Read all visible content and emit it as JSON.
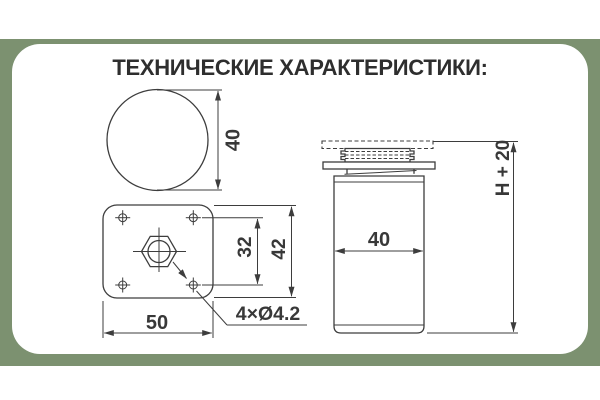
{
  "page": {
    "band_color": "#7c9170",
    "card_color": "#ffffff",
    "line_color": "#3d3d3d",
    "text_color": "#2e2e2e"
  },
  "header": {
    "title": "ТЕХНИЧЕСКИЕ ХАРАКТЕРИСТИКИ:"
  },
  "drawing": {
    "top_view": {
      "diameter_label": "40"
    },
    "plate_view": {
      "hole_spacing_label": "32",
      "height_label": "42",
      "width_label": "50",
      "holes_label": "4×Ø4.2"
    },
    "side_view": {
      "width_label": "40",
      "height_label": "H + 20"
    }
  }
}
